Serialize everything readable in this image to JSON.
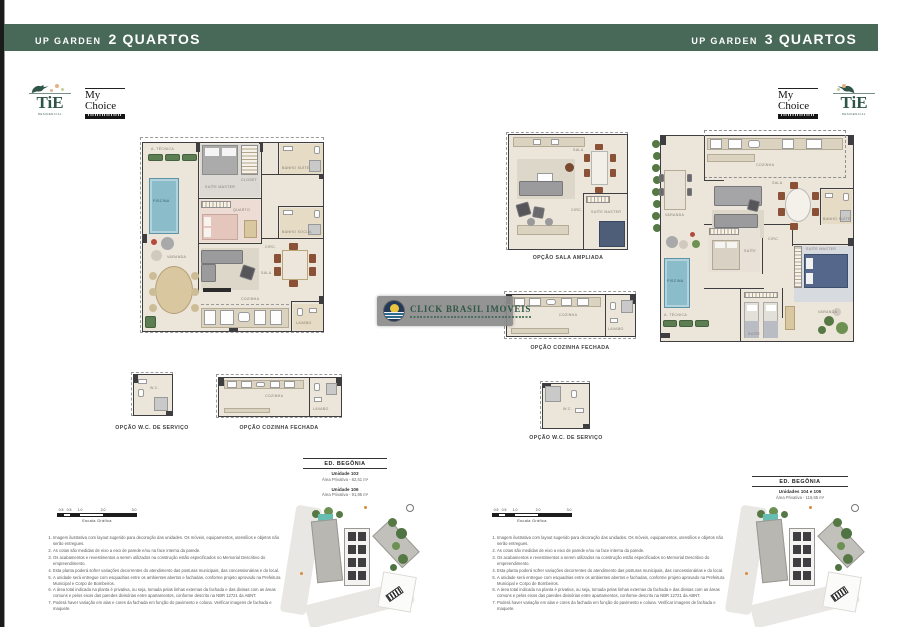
{
  "banners": {
    "left_prefix": "UP GARDEN",
    "left_bold": "2 QUARTOS",
    "right_prefix": "UP GARDEN",
    "right_bold": "3 QUARTOS"
  },
  "logos": {
    "tie": "TiE",
    "tie_sub": "RESIDENCIAL",
    "mychoice_top": "My",
    "mychoice_bottom": "Choice"
  },
  "watermark": {
    "name": "CLICK BRASIL IMOVEIS"
  },
  "plan_labels": {
    "left_wc": "OPÇÃO W.C. DE SERVIÇO",
    "left_cozinha": "OPÇÃO COZINHA FECHADA",
    "mid_sala": "OPÇÃO SALA AMPLIADA",
    "mid_cozinha": "OPÇÃO COZINHA FECHADA",
    "mid_wc": "OPÇÃO W.C. DE SERVIÇO"
  },
  "rooms": {
    "p2q": [
      "A. TÉCNICA",
      "PISCINA",
      "VARANDA",
      "SUÍTE MASTER",
      "CLOSET",
      "QUARTO",
      "BANHO SUÍTE",
      "BANHO SOCIAL",
      "CIRC.",
      "SALA",
      "COZINHA",
      "LAVABO"
    ],
    "p3q": [
      "COZINHA",
      "VARANDA",
      "SALA",
      "SUÍTE",
      "CIRC.",
      "SUÍTE MASTER",
      "BANHO SUÍTE",
      "PISCINA",
      "A. TÉCNICA",
      "SUÍTE",
      "VARANDA"
    ],
    "sala": [
      "SALA",
      "CIRC.",
      "SUÍTE MASTER"
    ],
    "cozinha": [
      "COZINHA",
      "LAVABO"
    ],
    "wc": "W.C."
  },
  "unit_info_left": {
    "title": "ED. BEGÔNIA",
    "units": [
      {
        "name": "Unidade 103",
        "area": "Área Privativa - 82,51 m²"
      },
      {
        "name": "Unidade 106",
        "area": "Área Privativa - 91,85 m²"
      }
    ]
  },
  "unit_info_right": {
    "title": "ED. BEGÔNIA",
    "units": [
      {
        "name": "Unidades 104 e 105",
        "area": "Área Privativa - 116,65 m²"
      }
    ]
  },
  "scale": {
    "label": "Escala Gráfica",
    "ticks": [
      "0.5",
      "0.5",
      "1.0",
      "2.0",
      "3.0"
    ]
  },
  "disclaimer": [
    "Imagem ilustrativa com layout sugerido para decoração das unidades. Os móveis, equipamentos, utensílios e objetos não serão entregues.",
    "As cotas são medidas de eixo a eixo de parede e/ou na face interna da parede.",
    "Os acabamentos e revestimentos a serem utilizados na construção estão especificados no Memorial Descritivo do empreendimento.",
    "Esta planta poderá sofrer variações decorrentes do atendimento das posturas municipais, das concessionárias e do local.",
    "A unidade será entregue com esquadrias entre os ambientes abertos e fachadas, conforme projeto aprovado na Prefeitura Municipal e Corpo de Bombeiros.",
    "A área total indicada na planta é privativa, ou seja, tomada pelas linhas externas da fachada e das divisas com as áreas comuns e pelos eixos das paredes divisórias entre apartamentos, conforme descrito na NBR 12721 da ABNT.",
    "Poderá haver variação em alas e cores da fachada em função do pavimento e coluna. Verificar imagens de fachada e maquete."
  ],
  "colors": {
    "banner_green": "#486858",
    "logo_green": "#2E5546",
    "floor_cream": "#ECE5D9",
    "wall_dark": "#3E3E40",
    "pool_blue": "#8ABCCA",
    "plant_green": "#5D7D52",
    "wood": "#D9C7A0",
    "bed_pink": "#E5C6BD",
    "bed_gray": "#ABABAB",
    "bed_blue": "#55678A",
    "watermark_text": "#2F5847"
  }
}
